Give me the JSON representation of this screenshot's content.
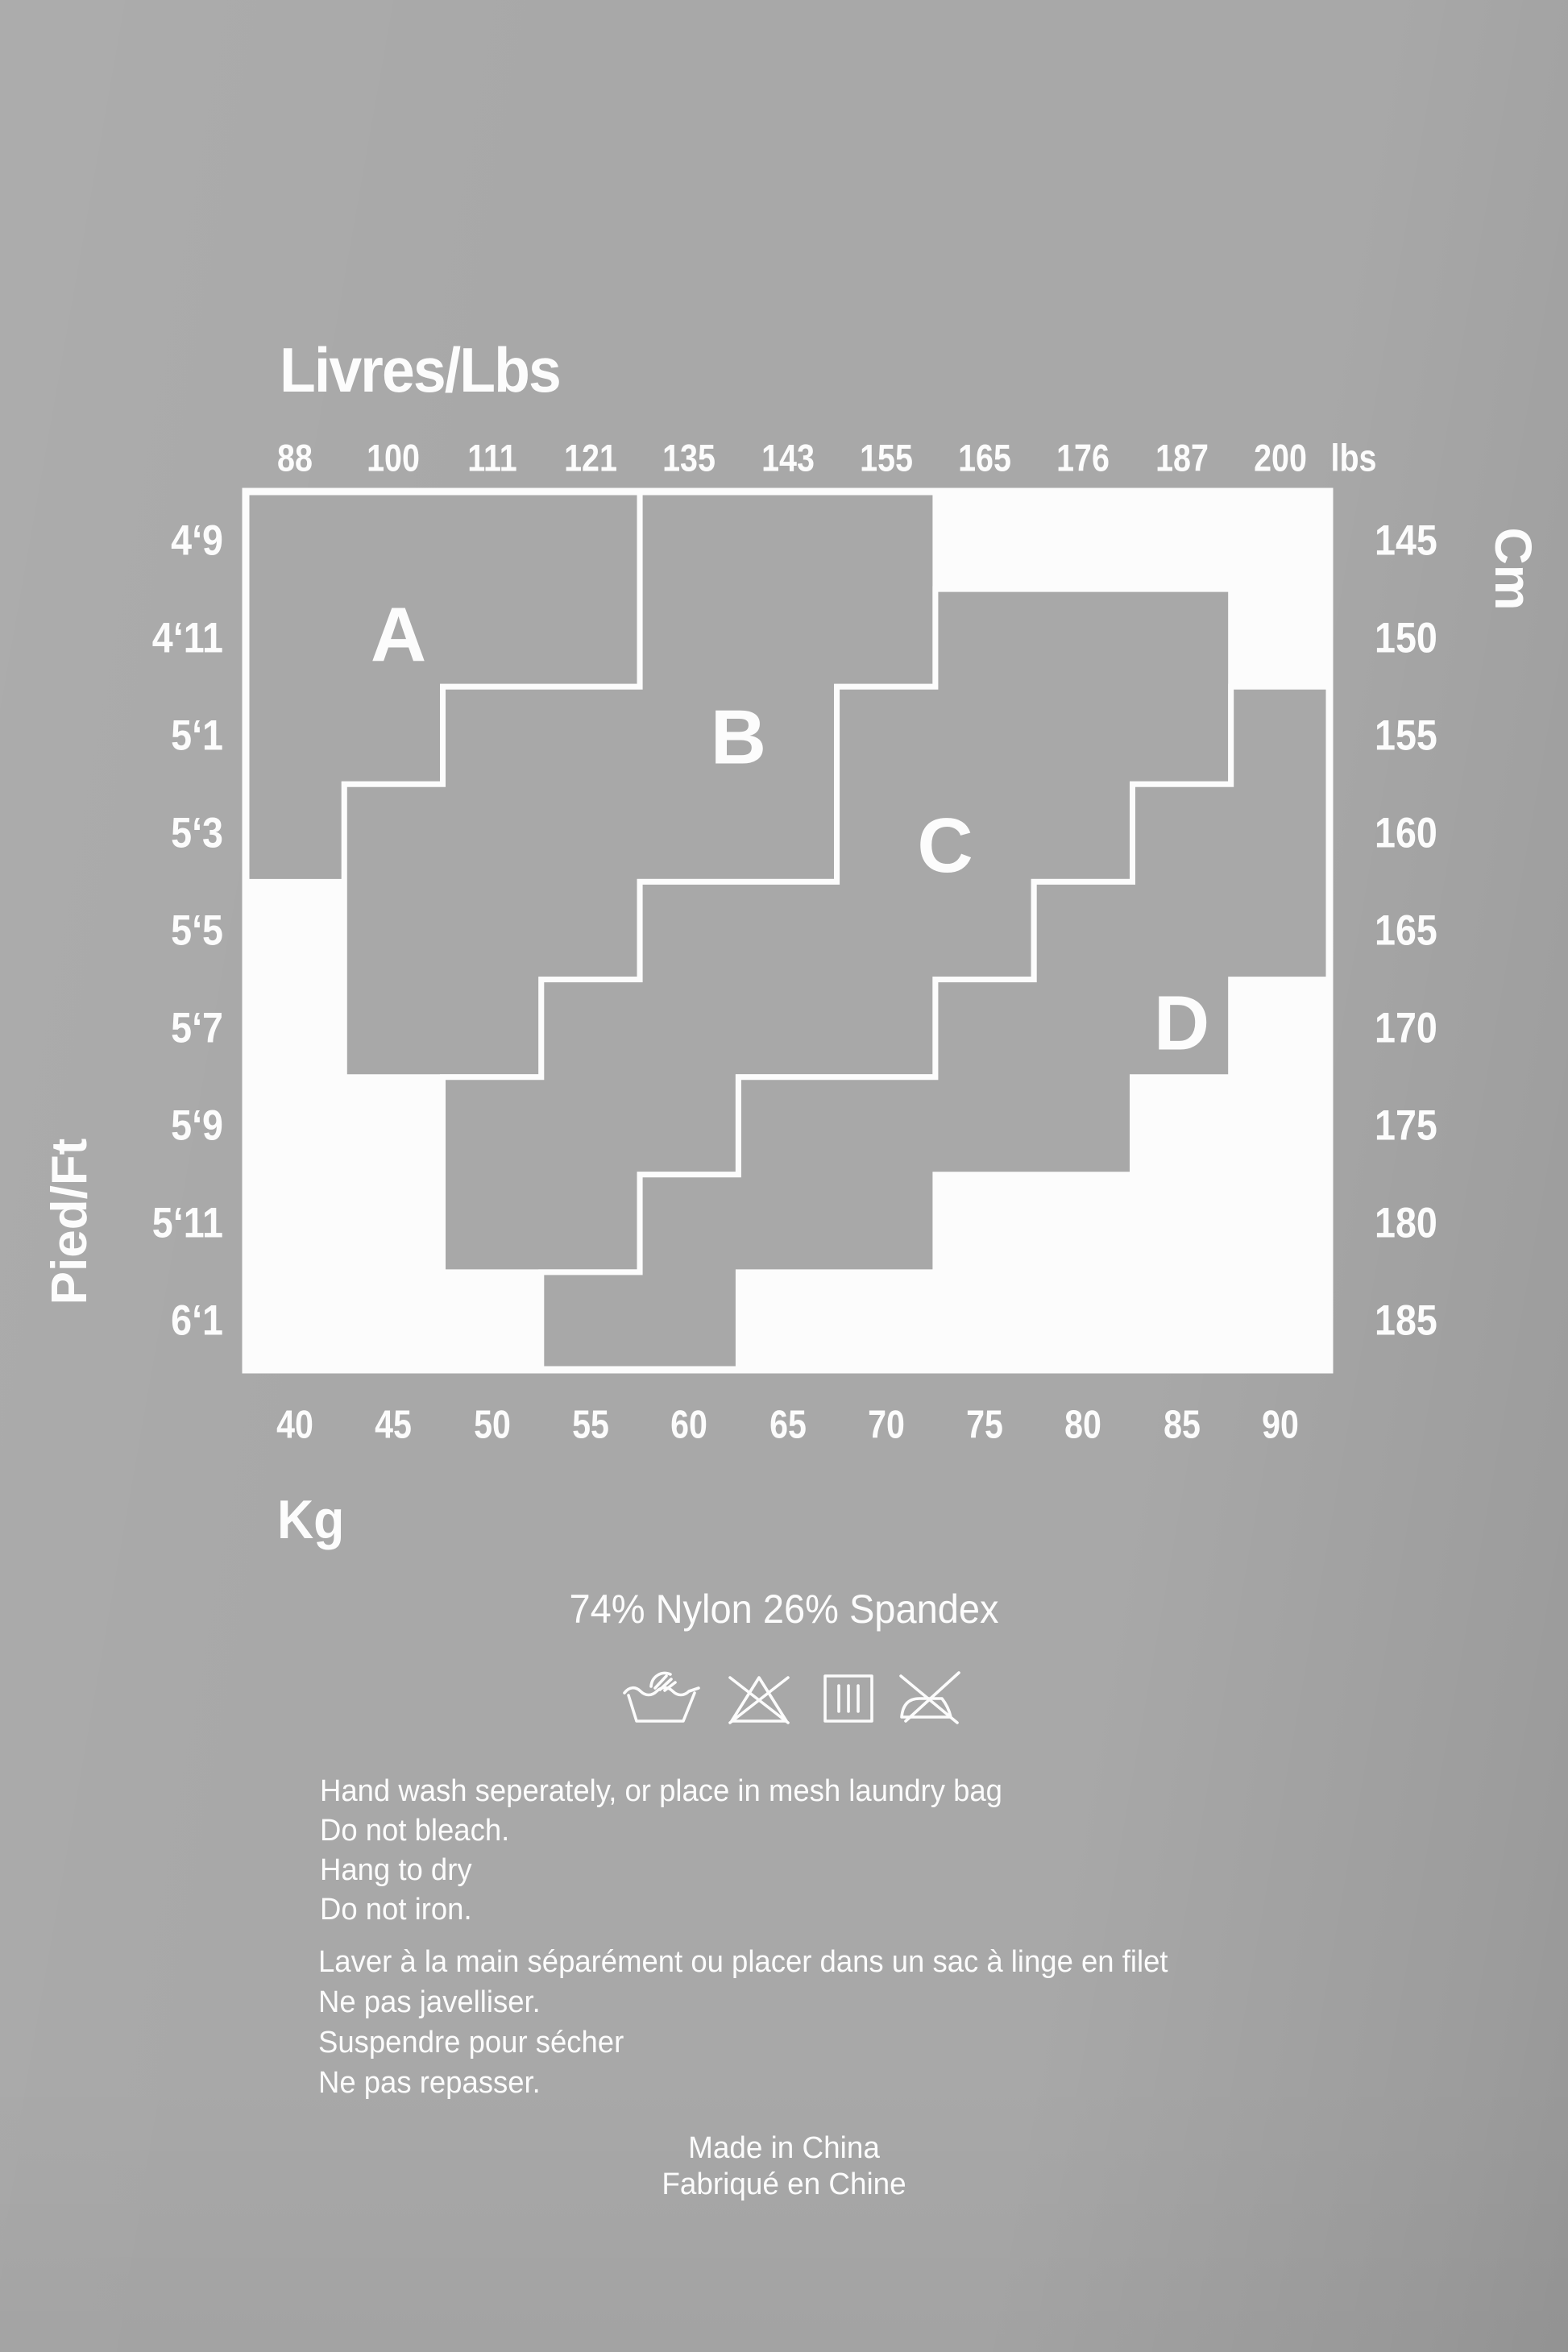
{
  "colors": {
    "page_background": "#a8a8a8",
    "zone_fill": "#a8a8a8",
    "empty_cell": "#fcfcfc",
    "boundary_line": "#fcfcfc",
    "text": "#fcfcfc"
  },
  "chart_data": {
    "type": "zone-grid",
    "title": "Livres/Lbs",
    "grid": {
      "cols": 11,
      "rows": 9
    },
    "axes": {
      "top": {
        "label": "Livres/Lbs",
        "unit_suffix": "lbs",
        "values": [
          "88",
          "100",
          "111",
          "121",
          "135",
          "143",
          "155",
          "165",
          "176",
          "187",
          "200"
        ]
      },
      "bottom": {
        "label": "Kg",
        "values": [
          "40",
          "45",
          "50",
          "55",
          "60",
          "65",
          "70",
          "75",
          "80",
          "85",
          "90"
        ]
      },
      "left": {
        "label": "Pied/Ft",
        "values": [
          "4‘9",
          "4‘11",
          "5‘1",
          "5‘3",
          "5‘5",
          "5‘7",
          "5‘9",
          "5‘11",
          "6‘1"
        ]
      },
      "right": {
        "label": "Cm",
        "values": [
          "145",
          "150",
          "155",
          "160",
          "165",
          "170",
          "175",
          "180",
          "185"
        ]
      }
    },
    "zones": [
      {
        "label": "A",
        "label_pos": [
          1.55,
          1.47
        ],
        "rows": {
          "0": [
            0,
            4
          ],
          "1": [
            0,
            4
          ],
          "2": [
            0,
            2
          ],
          "3": [
            0,
            1
          ]
        }
      },
      {
        "label": "B",
        "label_pos": [
          5.0,
          2.52
        ],
        "rows": {
          "0": [
            4,
            7
          ],
          "1": [
            4,
            7
          ],
          "2": [
            2,
            6
          ],
          "3": [
            1,
            6
          ],
          "4": [
            1,
            4
          ],
          "5": [
            1,
            3
          ]
        }
      },
      {
        "label": "C",
        "label_pos": [
          7.1,
          3.63
        ],
        "rows": {
          "1": [
            7,
            10
          ],
          "2": [
            6,
            10
          ],
          "3": [
            6,
            9
          ],
          "4": [
            4,
            8
          ],
          "5": [
            3,
            7
          ],
          "6": [
            2,
            5
          ],
          "7": [
            2,
            4
          ]
        }
      },
      {
        "label": "D",
        "label_pos": [
          9.5,
          5.45
        ],
        "rows": {
          "2": [
            10,
            11
          ],
          "3": [
            9,
            11
          ],
          "4": [
            8,
            11
          ],
          "5": [
            7,
            10
          ],
          "6": [
            5,
            9
          ],
          "7": [
            4,
            7
          ],
          "8": [
            3,
            5
          ]
        }
      }
    ]
  },
  "composition_label": "74% Nylon 26% Spandex",
  "care_icons": [
    {
      "name": "hand-wash-icon"
    },
    {
      "name": "do-not-bleach-icon"
    },
    {
      "name": "hang-to-dry-icon"
    },
    {
      "name": "do-not-iron-icon"
    }
  ],
  "care_instructions_en": [
    "Hand wash seperately, or place in mesh laundry bag",
    "Do not bleach.",
    "Hang to dry",
    "Do not iron."
  ],
  "care_instructions_fr": [
    "Laver à la main séparément ou placer dans un sac à linge en filet",
    "Ne pas javelliser.",
    "Suspendre pour sécher",
    "Ne pas repasser."
  ],
  "origin_lines": [
    "Made in China",
    "Fabriqué en Chine"
  ]
}
